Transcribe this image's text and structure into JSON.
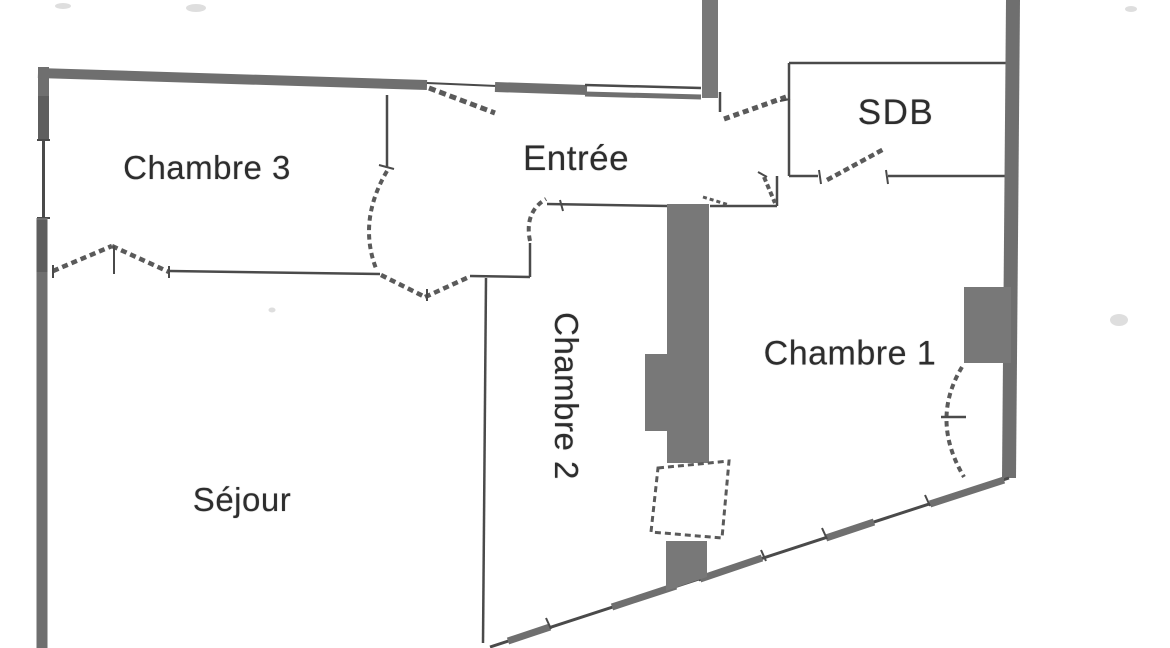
{
  "colors": {
    "background": "#ffffff",
    "wall": "#6f6f6f",
    "wall_dark": "#5e5e5e",
    "line": "#4a4a4a",
    "door": "#5a5a5a",
    "fill_duct": "#787878",
    "text": "#2d2d2d"
  },
  "rooms": [
    {
      "id": "chambre3",
      "label": "Chambre 3"
    },
    {
      "id": "entree",
      "label": "Entrée"
    },
    {
      "id": "sdb",
      "label": "SDB"
    },
    {
      "id": "chambre2",
      "label": "Chambre 2"
    },
    {
      "id": "chambre1",
      "label": "Chambre 1"
    },
    {
      "id": "sejour",
      "label": "Séjour"
    }
  ]
}
